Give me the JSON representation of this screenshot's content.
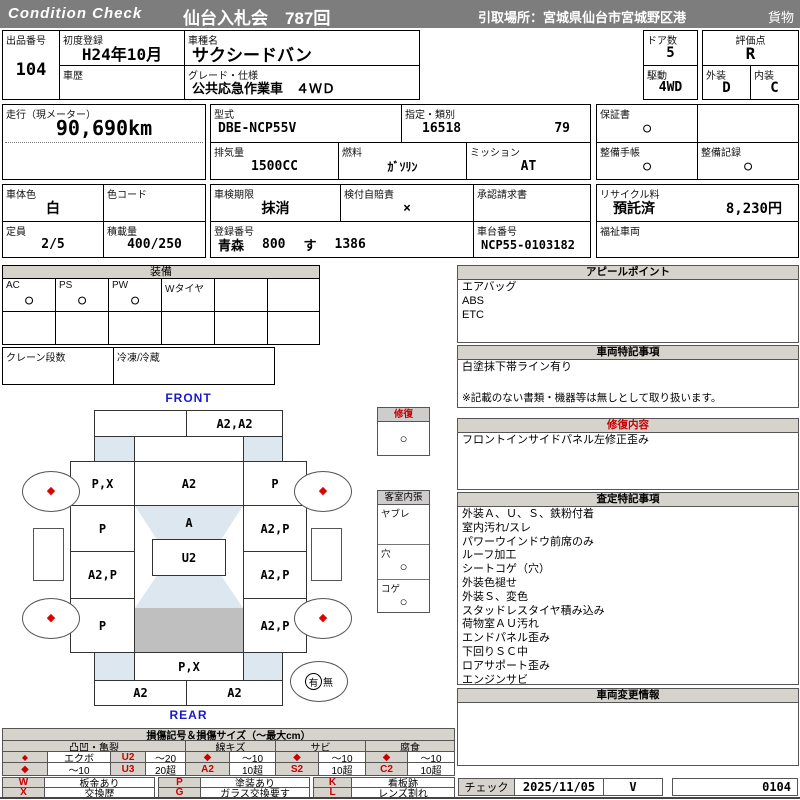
{
  "header": {
    "brand": "Condition  Check",
    "title": "仙台入札会　787回",
    "pickup": "引取場所：宮城県仙台市宮城野区港",
    "cargo": "貨物"
  },
  "info": {
    "lot": {
      "label": "出品番号",
      "value": "104"
    },
    "first_reg": {
      "label": "初度登録",
      "value": "H24年10月"
    },
    "history": {
      "label": "車歴",
      "value": ""
    },
    "model_name": {
      "label": "車種名",
      "value": "サクシードバン"
    },
    "grade": {
      "label": "グレード・仕様",
      "value": "公共応急作業車　４ＷＤ"
    },
    "doors": {
      "label": "ドア数",
      "value": "5"
    },
    "score": {
      "label": "評価点",
      "value": "R"
    },
    "drive": {
      "label": "駆動",
      "value": "4WD"
    },
    "exterior": {
      "label": "外装",
      "value": "D"
    },
    "interior": {
      "label": "内装",
      "value": "C"
    },
    "mileage": {
      "label": "走行（現メーター）",
      "value": "90,690km"
    },
    "model_code": {
      "label": "型式",
      "value": "DBE-NCP55V"
    },
    "type_class": {
      "label": "指定・類別",
      "value1": "16518",
      "value2": "79"
    },
    "displacement": {
      "label": "排気量",
      "value": "1500CC"
    },
    "fuel": {
      "label": "燃料",
      "value": "ｶﾞｿﾘﾝ"
    },
    "mission": {
      "label": "ミッション",
      "value": "AT"
    },
    "warranty": {
      "label": "保証書",
      "value": "○"
    },
    "maint_book": {
      "label": "整備手帳",
      "value": "○"
    },
    "maint_rec": {
      "label": "整備記録",
      "value": "○"
    },
    "body_color": {
      "label": "車体色",
      "value": "白"
    },
    "color_code": {
      "label": "色コード",
      "value": ""
    },
    "inspection": {
      "label": "車検期限",
      "value": "抹消"
    },
    "insurance": {
      "label": "検付自賠責",
      "value": "×"
    },
    "approval": {
      "label": "承認請求書",
      "value": ""
    },
    "recycle": {
      "label": "リサイクル料",
      "status": "預託済",
      "fee": "8,230円"
    },
    "capacity": {
      "label": "定員",
      "value": "2/5"
    },
    "load": {
      "label": "積載量",
      "value": "400/250"
    },
    "plate": {
      "label": "登録番号",
      "region": "青森",
      "cls": "800",
      "kana": "す",
      "num": "1386"
    },
    "vin": {
      "label": "車台番号",
      "value": "NCP55-0103182"
    },
    "welfare": {
      "label": "福祉車両",
      "value": ""
    }
  },
  "equipment": {
    "title": "装備",
    "items": [
      {
        "label": "AC",
        "value": "○"
      },
      {
        "label": "PS",
        "value": "○"
      },
      {
        "label": "PW",
        "value": "○"
      },
      {
        "label": "Wタイヤ",
        "value": ""
      },
      {
        "label": "",
        "value": ""
      },
      {
        "label": "",
        "value": ""
      }
    ],
    "crane": {
      "label": "クレーン段数",
      "value": ""
    },
    "fridge": {
      "label": "冷凍/冷蔵",
      "value": ""
    }
  },
  "repair_box": {
    "title": "修復",
    "value": "○"
  },
  "cabin_box": {
    "title": "客室内張",
    "rows": [
      {
        "label": "ヤブレ",
        "value": ""
      },
      {
        "label": "穴",
        "value": "○"
      },
      {
        "label": "コゲ",
        "value": "○"
      }
    ]
  },
  "diagram": {
    "front": "FRONT",
    "rear": "REAR",
    "wheel_mark": "◆",
    "top_bumper_left": "",
    "top_bumper_right": "A2,A2",
    "left_cells": [
      "P,X",
      "P",
      "A2,P",
      "P"
    ],
    "right_cells": [
      "P",
      "A2,P",
      "A2,P",
      "A2,P"
    ],
    "center_top": "A2",
    "windshield": "A",
    "roof": "U2",
    "bottom_center": "P,X",
    "bottom_bumper_left": "A2",
    "bottom_bumper_right": "A2",
    "spare_yes": "有",
    "spare_no": "無"
  },
  "panels": {
    "appeal": {
      "title": "アピールポイント",
      "lines": [
        "エアバッグ",
        "ABS",
        "ETC"
      ]
    },
    "notes": {
      "title": "車両特記事項",
      "lines": [
        "白塗抹下帯ライン有り"
      ],
      "footnote": "※記載のない書類・機器等は無しとして取り扱います。"
    },
    "repair": {
      "title": "修復内容",
      "lines": [
        "フロントインサイドパネル左修正歪み"
      ]
    },
    "assessment": {
      "title": "査定特記事項",
      "lines": [
        "外装Ａ、Ｕ、Ｓ、鉄粉付着",
        "室内汚れ/スレ",
        "パワーウインドウ前席のみ",
        "ルーフ加工",
        "シートコゲ（穴）",
        "外装色褪せ",
        "外装Ｓ、変色",
        "スタッドレスタイヤ積み込み",
        "荷物室ＡＵ汚れ",
        "エンドパネル歪み",
        "下回りＳＣ中",
        "ロアサポート歪み",
        "エンジンサビ"
      ]
    },
    "changes": {
      "title": "車両変更情報"
    }
  },
  "legend": {
    "title": "損傷記号＆損傷サイズ（～最大cm）",
    "groups": [
      {
        "name": "凸凹・亀裂",
        "r1": [
          "◆",
          "エクボ",
          "U2",
          "～20"
        ],
        "r2": [
          "◆",
          "～10",
          "U3",
          "20超"
        ]
      },
      {
        "name": "線キズ",
        "r1": [
          "◆",
          "～10"
        ],
        "r2": [
          "A2",
          "10超"
        ]
      },
      {
        "name": "サビ",
        "r1": [
          "◆",
          "～10"
        ],
        "r2": [
          "S2",
          "10超"
        ]
      },
      {
        "name": "腐食",
        "r1": [
          "◆",
          "～10"
        ],
        "r2": [
          "C2",
          "10超"
        ]
      }
    ],
    "codes": {
      "w": {
        "sym": "W",
        "label": "板金あり"
      },
      "x": {
        "sym": "X",
        "label": "交換歴"
      },
      "p": {
        "sym": "P",
        "label": "塗装あり"
      },
      "g": {
        "sym": "G",
        "label": "ガラス交換要す"
      },
      "k": {
        "sym": "K",
        "label": "看板跡"
      },
      "l": {
        "sym": "L",
        "label": "レンズ割れ"
      }
    }
  },
  "footer": {
    "check_label": "チェック",
    "date": "2025/11/05",
    "mark": "V",
    "number": "0104"
  }
}
